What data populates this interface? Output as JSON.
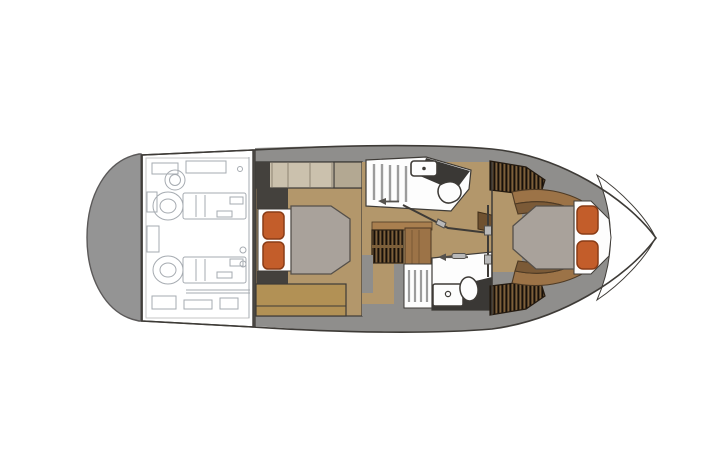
{
  "document": {
    "kind": "boat-floorplan",
    "view": "top-down-lower-deck",
    "orientation": {
      "bow": "right",
      "stern": "left"
    }
  },
  "palette": {
    "line": "#3e3b37",
    "hull-white": "#ffffff",
    "platform-gray": "#949494",
    "platform-stroke": "#5b5959",
    "deck-gray": "#8f8e8c",
    "floor-tan": "#b3976b",
    "cabinet-beige": "#cbc1ad",
    "cabinet-taupe": "#b3a892",
    "cabinet-divider": "#8f8573",
    "settee-gold": "#b29155",
    "mattress-gray": "#a9a29b",
    "mattress-stroke": "#55504a",
    "pillow-orange": "#c35d2a",
    "pillow-stroke": "#8a3c16",
    "slate-dark": "#44413d",
    "counter-dark": "#3a3835",
    "wood-mid": "#9c7347",
    "wood-dark": "#7b5a37",
    "wood-stroke": "#4e3a24",
    "louver-base": "#7d5f3a",
    "louver-stripe": "#17100a",
    "engine-line": "#a6abb1",
    "slat-gray": "#9c9c9c",
    "hardware-gray": "#b9b9b9",
    "hardware-stroke": "#55524e",
    "fixture-white": "#fdfdfd"
  },
  "inventory": {
    "swim_platform": 1,
    "engine_room_engines": 2,
    "cabins": [
      {
        "id": "aft-cabin",
        "bed": "double",
        "pillows": 2
      },
      {
        "id": "forward-cabin",
        "bed": "v-berth",
        "pillows": 2
      }
    ],
    "heads": [
      {
        "id": "head-upper",
        "fixtures": [
          "sink",
          "toilet",
          "shower-slats"
        ]
      },
      {
        "id": "head-lower",
        "fixtures": [
          "sink",
          "toilet",
          "shower-slats"
        ]
      }
    ],
    "stairs": [
      "companionway-stairs"
    ],
    "closets": [
      "forward-closet-upper",
      "forward-closet-lower"
    ]
  }
}
